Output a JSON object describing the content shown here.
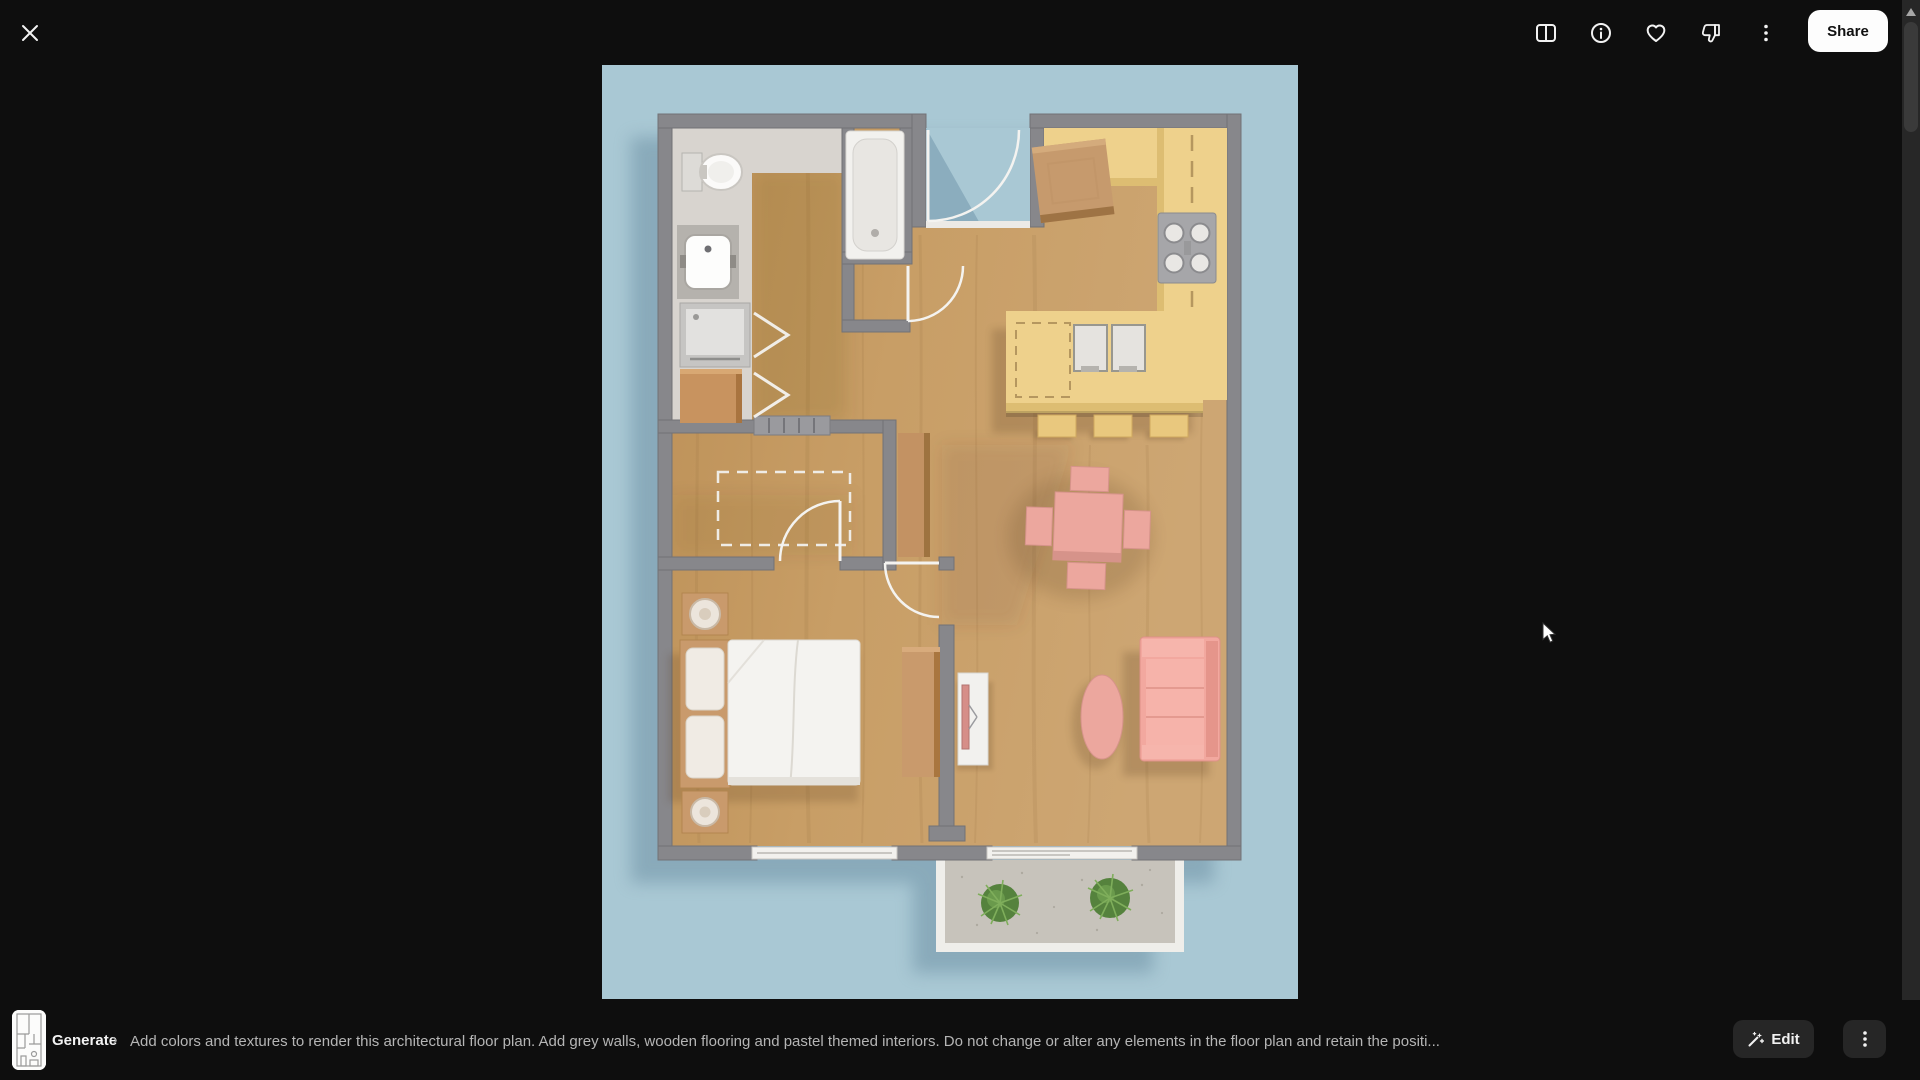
{
  "topbar": {
    "share_label": "Share",
    "icons": [
      "compare-icon",
      "info-icon",
      "favorite-icon",
      "thumbs-down-icon",
      "more-options-icon"
    ]
  },
  "bottom_bar": {
    "generate_label": "Generate",
    "chevron": "›",
    "prompt_text": "Add colors and textures to render this architectural floor plan. Add grey walls, wooden flooring and pastel themed interiors. Do not change or alter any elements in the floor plan and retain the positi...",
    "edit_label": "Edit"
  },
  "viewer": {
    "content": "3D rendered architectural floor plan, top-down view",
    "background_color": "#a9c8d4",
    "wall_color": "#87878b",
    "floor_color": "#c89e66",
    "kitchen_color": "#eed18c",
    "pastel_pink": "#eca79e",
    "wood_furniture_color": "#c99a6c",
    "rooms": [
      "bathroom",
      "entry",
      "kitchen",
      "closet",
      "bedroom",
      "living-dining",
      "balcony"
    ],
    "furniture": [
      "toilet",
      "sink",
      "washing-machine",
      "bathtub",
      "kitchen-counter",
      "stove",
      "kitchen-island",
      "bar-stools",
      "dining-table",
      "dining-chairs",
      "sofa",
      "coffee-table",
      "tv-console",
      "bed",
      "nightstands",
      "dresser",
      "balcony-plants"
    ]
  }
}
